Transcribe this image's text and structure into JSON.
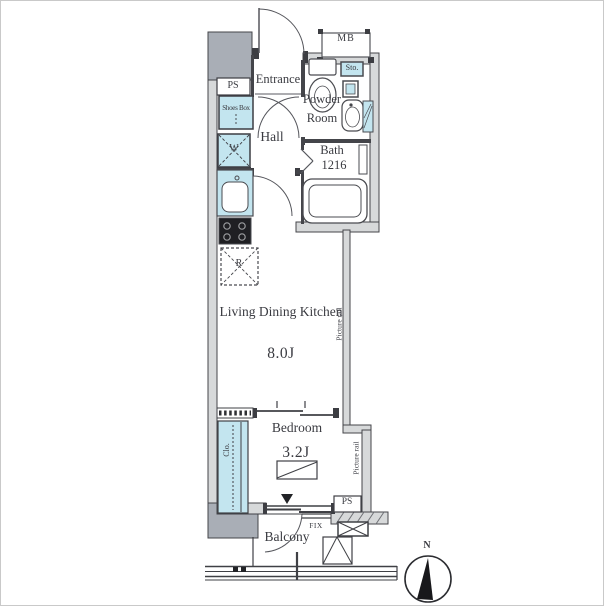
{
  "plan": {
    "rooms": {
      "entrance": {
        "label": "Entrance"
      },
      "powder_room": {
        "label": "Powder Room"
      },
      "hall": {
        "label": "Hall"
      },
      "bath": {
        "label": "Bath",
        "size": "1216"
      },
      "ldk": {
        "label": "Living Dining Kitchen",
        "size": "8.0J"
      },
      "bedroom": {
        "label": "Bedroom",
        "size": "3.2J"
      },
      "balcony": {
        "label": "Balcony"
      }
    },
    "features": {
      "meter_box": "MB",
      "pipe_space_upper": "PS",
      "pipe_space_lower": "PS",
      "shoes_box": "Shoes Box",
      "storage": "Sto.",
      "washing_machine": "W",
      "refrigerator": "R",
      "closet": "Clo.",
      "fixed_window": "FIX",
      "picture_rail_ldk": "Picture rail",
      "picture_rail_bedroom": "Picture rail"
    },
    "compass": {
      "north": "N"
    },
    "colors": {
      "fixture_blue": "#c3e5ef",
      "shaft_gray": "#a9aeb6",
      "wall_fill": "#d7d9da",
      "line": "#44454a",
      "text": "#3a3b41",
      "background": "#ffffff"
    }
  }
}
